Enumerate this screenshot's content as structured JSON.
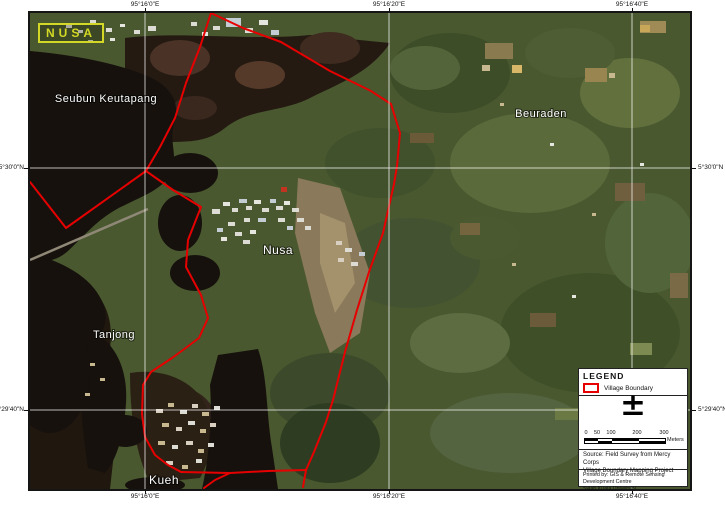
{
  "badge": {
    "text": "NUSA"
  },
  "coords": {
    "top": [
      "95°16'0\"E",
      "95°16'20\"E",
      "95°16'40\"E"
    ],
    "bottom": [
      "95°16'0\"E",
      "95°16'20\"E",
      "95°16'40\"E"
    ],
    "left": [
      "5°30'0\"N",
      "5°29'40\"N"
    ],
    "right": [
      "5°30'0\"N",
      "5°29'40\"N"
    ]
  },
  "places": {
    "seubun": "Seubun Keutapang",
    "beuraden": "Beuraden",
    "nusa": "Nusa",
    "tanjong": "Tanjong",
    "kueh": "Kueh"
  },
  "legend": {
    "title": "LEGEND",
    "items": [
      {
        "label": "Village Boundary",
        "symbol_color": "#e60000"
      }
    ],
    "north_arrow_glyph": "±",
    "scale": {
      "ticks": [
        "0",
        "50",
        "100",
        "200",
        "300"
      ],
      "unit": "Meters"
    },
    "source": [
      "Source: Field Survey from Mercy Corps",
      "Village Boundary Mapping Project"
    ],
    "credits": [
      "Printed by: GIS & Remote Sensing Development Centre",
      "Syiah Kuala University"
    ]
  },
  "colors": {
    "village_boundary": "#e60000",
    "badge_yellow": "#d2d825"
  }
}
